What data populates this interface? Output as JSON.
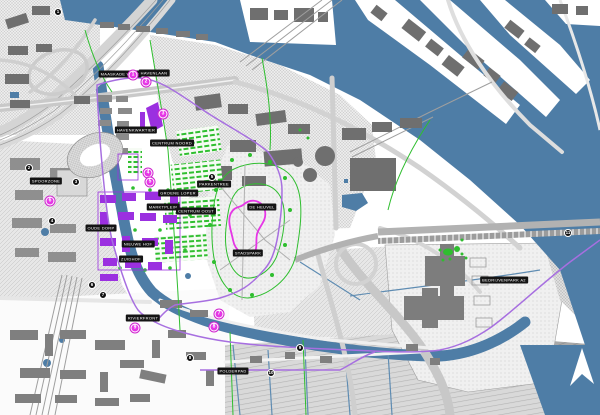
{
  "map": {
    "type": "urban-development-plan-map",
    "colors": {
      "water": "#4e7da6",
      "green": "#2fbe2f",
      "magenta_marker": "#e636e6",
      "mound_contour": "#e636e6",
      "new_buildings_purple": "#9b30e0",
      "plan_boundary_violet": "#a76fe0",
      "building_gray": "#6f6f6f",
      "label_background": "#141414",
      "label_text": "#ffffff"
    },
    "labels": [
      {
        "text": "MAASKADE WEST"
      },
      {
        "text": "HAVENLAAN"
      },
      {
        "text": "HAVENKWARTIER"
      },
      {
        "text": "CENTRUM NOORD"
      },
      {
        "text": "GROENE LOPER"
      },
      {
        "text": "MARKTPLEIN"
      },
      {
        "text": "CENTRUM OOST"
      },
      {
        "text": "OUDE DORP"
      },
      {
        "text": "NIEUWE HOF"
      },
      {
        "text": "ZUIDHOF"
      },
      {
        "text": "SPOORZONE"
      },
      {
        "text": "DE HEUVEL"
      },
      {
        "text": "STADSPARK"
      },
      {
        "text": "RIVIERFRONT"
      },
      {
        "text": "POLDERPAD"
      },
      {
        "text": "BEDRIJVENPARK A2"
      },
      {
        "text": "PARKENTREE"
      }
    ],
    "magenta_markers": [
      {
        "n": "1"
      },
      {
        "n": "2"
      },
      {
        "n": "3"
      },
      {
        "n": "4"
      },
      {
        "n": "5"
      },
      {
        "n": "6"
      },
      {
        "n": "7"
      },
      {
        "n": "8"
      },
      {
        "n": "9"
      }
    ],
    "black_markers": [
      {
        "n": "1"
      },
      {
        "n": "2"
      },
      {
        "n": "3"
      },
      {
        "n": "4"
      },
      {
        "n": "5"
      },
      {
        "n": "6"
      },
      {
        "n": "7"
      },
      {
        "n": "8"
      },
      {
        "n": "9"
      },
      {
        "n": "10"
      },
      {
        "n": "11"
      }
    ]
  }
}
